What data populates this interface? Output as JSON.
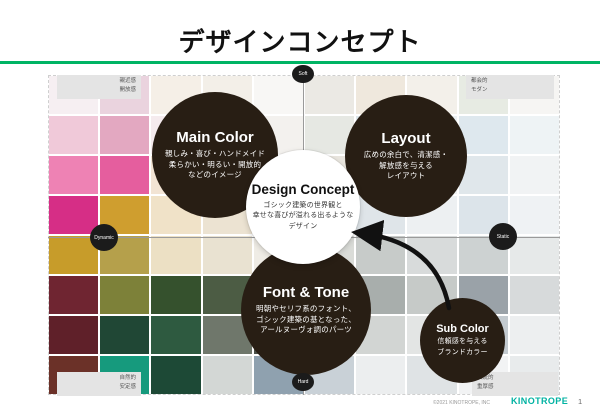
{
  "slide": {
    "title": "デザインコンセプト",
    "page_number": "1"
  },
  "footer": {
    "copyright": "©2021 KINOTROPE, INC",
    "logo": "KINOTROPE"
  },
  "colors": {
    "accent_green": "#00b464",
    "logo_teal": "#00b2a2",
    "circle_dark": "#281e14",
    "axis_gray": "#9a9a9a",
    "corner_box_bg": "#e4e4e4"
  },
  "axes": {
    "top": "Soft",
    "bottom": "Hard",
    "left": "Dynamic",
    "right": "Static"
  },
  "corners": {
    "top_left": {
      "line1": "親近感",
      "line2": "開放感"
    },
    "top_right": {
      "line1": "都会的",
      "line2": "モダン"
    },
    "bottom_left": {
      "line1": "自然的",
      "line2": "安定感"
    },
    "bottom_right": {
      "line1": "伝統的",
      "line2": "重厚感"
    }
  },
  "circles": {
    "main_color": {
      "title": "Main Color",
      "lines": [
        "親しみ・喜び・ハンドメイド",
        "柔らかい・明るい・開放的",
        "などのイメージ"
      ]
    },
    "layout": {
      "title": "Layout",
      "lines": [
        "広めの余白で、清潔感・",
        "解放感を与える",
        "レイアウト"
      ]
    },
    "design_concept": {
      "title": "Design Concept",
      "lines": [
        "ゴシック建築の世界観と",
        "幸せな喜びが溢れる出るような",
        "デザイン"
      ]
    },
    "font_tone": {
      "title": "Font & Tone",
      "lines": [
        "明朝やセリフ系のフォント、",
        "ゴシック建築の基となった、",
        "アールヌーヴォ調のパーツ"
      ]
    },
    "sub_color": {
      "title": "Sub Color",
      "lines": [
        "信頼感を与える",
        "ブランドカラー"
      ]
    }
  },
  "board": {
    "cell_colors": [
      [
        "#f6eff2",
        "#ead3de",
        "#f5efe7",
        "#f3efe8",
        "#f8f7f5",
        "#ebe9e4",
        "#efe8dd",
        "#f3f0ea",
        "#e7ebe3",
        "#f6f5f3"
      ],
      [
        "#f0c9d9",
        "#e3a8c1",
        "#f5ebee",
        "#efe6e1",
        "#f3f1ee",
        "#e6e8e3",
        "#dde6ea",
        "#ecf1f3",
        "#dee8ee",
        "#eef3f5"
      ],
      [
        "#ee82b4",
        "#e55e9e",
        "#f2e4d4",
        "#eddcc0",
        "#f5eee0",
        "#e8e5de",
        "#e4e8ea",
        "#eef0f1",
        "#e0e7eb",
        "#f1f3f4"
      ],
      [
        "#d62e86",
        "#cf9e2f",
        "#f0e2c8",
        "#ece3d2",
        "#f2efe9",
        "#e7e9e8",
        "#dfe5e9",
        "#edf0f2",
        "#dce4ea",
        "#eff2f4"
      ],
      [
        "#c79c2a",
        "#b5a04b",
        "#ece0c4",
        "#e9e2d1",
        "#efece5",
        "#dadcd8",
        "#c7cbc9",
        "#d8dbdb",
        "#cdd2d2",
        "#e6e9e9"
      ],
      [
        "#6f2531",
        "#7d8139",
        "#35512d",
        "#4c5c44",
        "#dfdcd2",
        "#c2c6c0",
        "#a8aeac",
        "#c6cac8",
        "#9aa2a8",
        "#d7dadb"
      ],
      [
        "#5f2029",
        "#204735",
        "#2e5a40",
        "#6f776b",
        "#4b5048",
        "#b9bdb9",
        "#d2d5d3",
        "#e3e5e4",
        "#c3cacf",
        "#edeff0"
      ],
      [
        "#6b3128",
        "#169a7d",
        "#1d4936",
        "#d3d7d5",
        "#8fa1af",
        "#c9d1d7",
        "#eceeef",
        "#dfe3e5",
        "#f2f3f4",
        "#e8ebec"
      ]
    ]
  }
}
